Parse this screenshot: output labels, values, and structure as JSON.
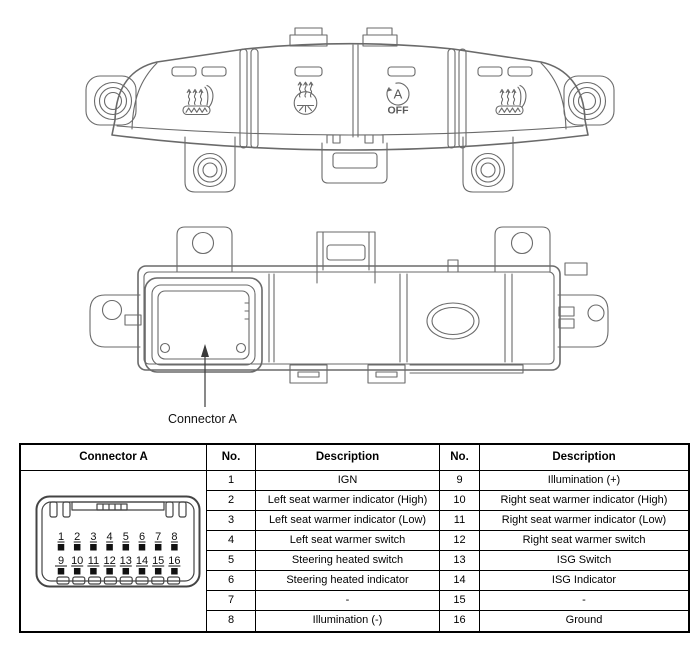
{
  "colors": {
    "background": "#ffffff",
    "drawing_line": "#6a6a6a",
    "inset_line": "#444444",
    "table_border": "#000000",
    "text": "#000000"
  },
  "front_view": {
    "description": "switch-assembly-front-view",
    "isg": {
      "letter": "A",
      "off_label": "OFF"
    }
  },
  "rear_view": {
    "description": "switch-assembly-rear-view",
    "callout_label": "Connector A"
  },
  "connector_inset": {
    "top_pins": [
      "1",
      "2",
      "3",
      "4",
      "5",
      "6",
      "7",
      "8"
    ],
    "bottom_pins": [
      "9",
      "10",
      "11",
      "12",
      "13",
      "14",
      "15",
      "16"
    ]
  },
  "table": {
    "headers": [
      "Connector A",
      "No.",
      "Description",
      "No.",
      "Description"
    ],
    "rows": [
      [
        "1",
        "IGN",
        "9",
        "Illumination (+)"
      ],
      [
        "2",
        "Left seat warmer indicator (High)",
        "10",
        "Right seat warmer indicator (High)"
      ],
      [
        "3",
        "Left seat warmer indicator (Low)",
        "11",
        "Right seat warmer indicator (Low)"
      ],
      [
        "4",
        "Left seat warmer switch",
        "12",
        "Right seat warmer switch"
      ],
      [
        "5",
        "Steering heated switch",
        "13",
        "ISG Switch"
      ],
      [
        "6",
        "Steering heated indicator",
        "14",
        "ISG Indicator"
      ],
      [
        "7",
        "-",
        "15",
        "-"
      ],
      [
        "8",
        "Illumination (-)",
        "16",
        "Ground"
      ]
    ]
  }
}
